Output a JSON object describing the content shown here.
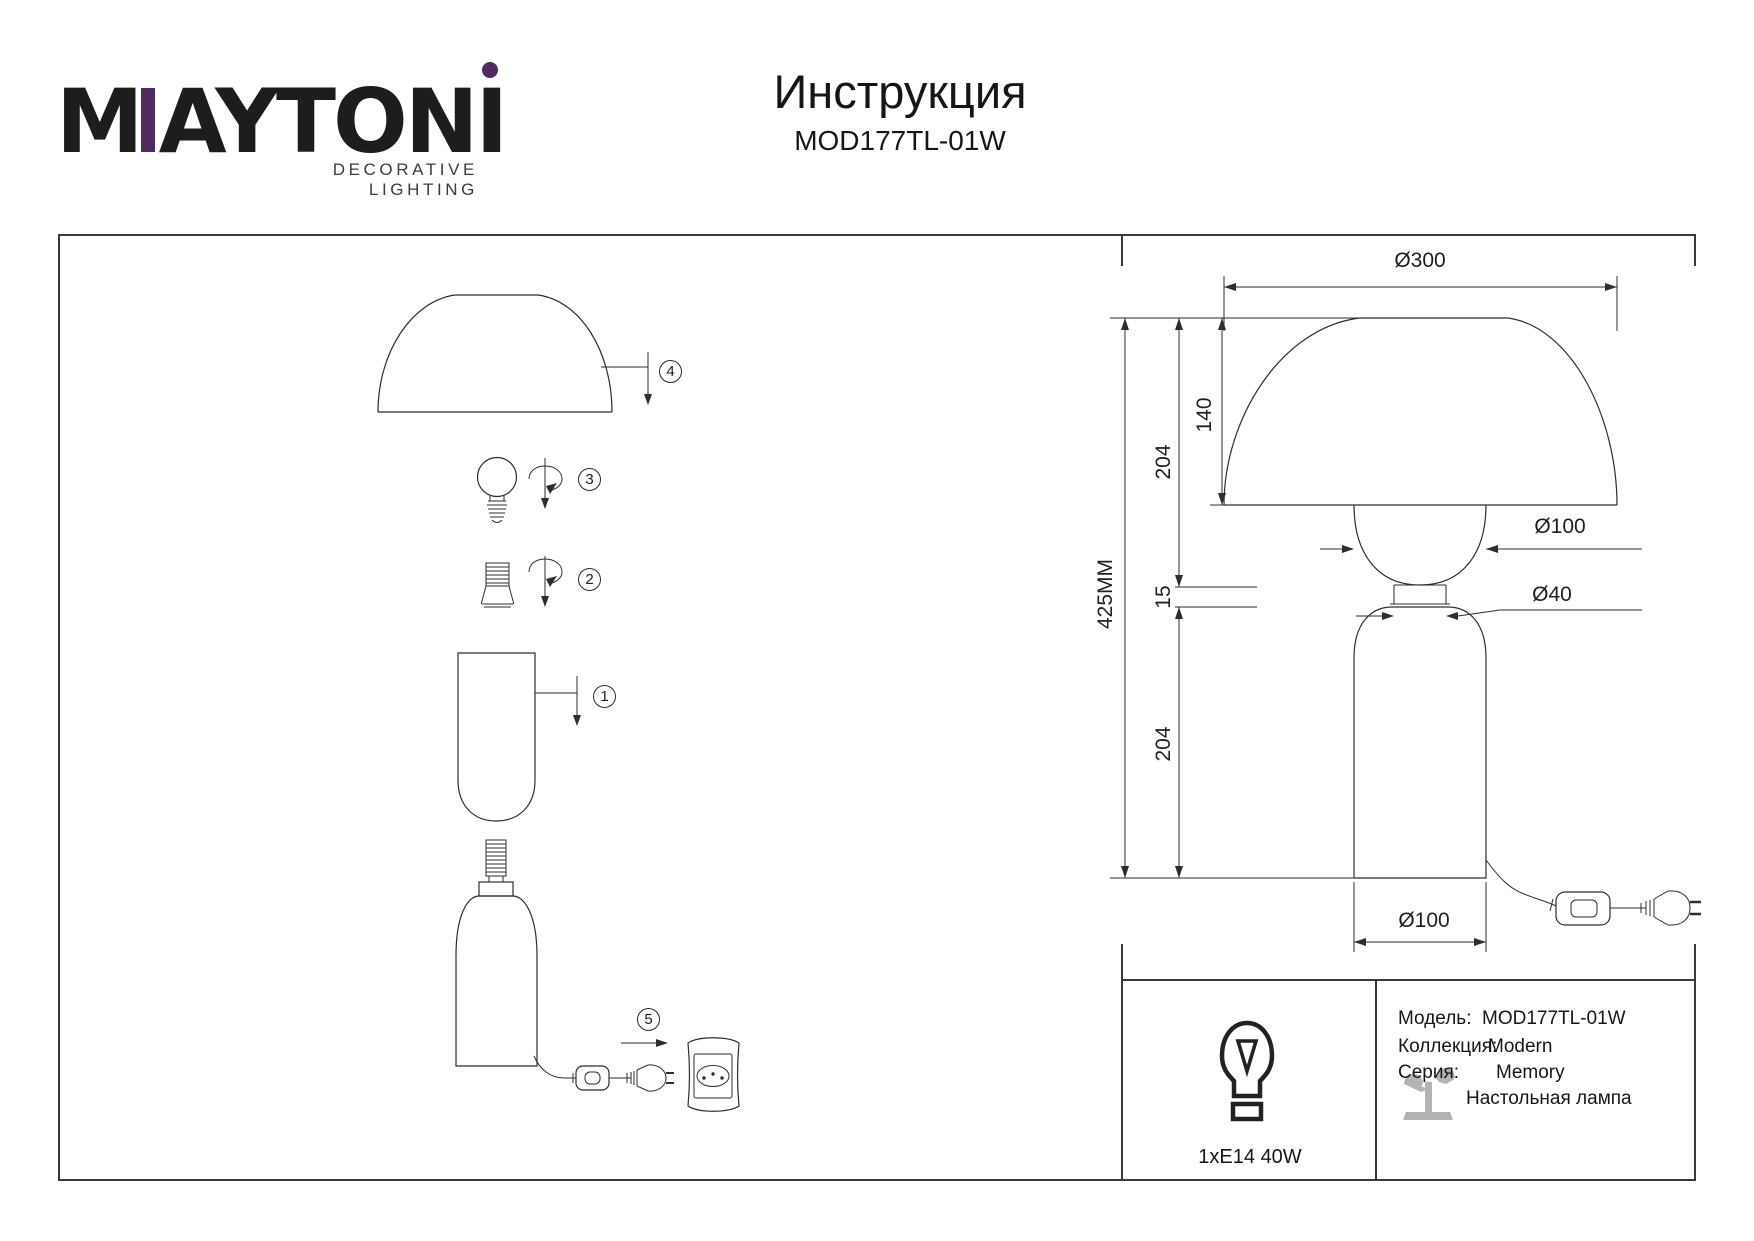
{
  "colors": {
    "accent": "#4f2a5e",
    "icon-gray": "#b3b3b3"
  },
  "brand": {
    "m": "M",
    "aytoni": "AYTON",
    "i": "I",
    "tagline": "DECORATIVE LIGHTING"
  },
  "header": {
    "title": "Инструкция",
    "model": "MOD177TL-01W"
  },
  "steps": [
    "1",
    "2",
    "3",
    "4",
    "5"
  ],
  "dims": {
    "shade_diameter": "Ø300",
    "shade_height": "140",
    "upper_height": "204",
    "total_height": "425MM",
    "gap": "15",
    "lower_height": "204",
    "glass_diameter": "Ø100",
    "neck_diameter": "Ø40",
    "base_diameter": "Ø100"
  },
  "spec": {
    "bulb": "1xE14 40W",
    "rows": [
      {
        "label": "Модель:",
        "value": "MOD177TL-01W"
      },
      {
        "label": "Коллекция:",
        "value": "Modern"
      },
      {
        "label": "Серия:",
        "value": "Memory"
      }
    ],
    "type": "Настольная лампа"
  }
}
